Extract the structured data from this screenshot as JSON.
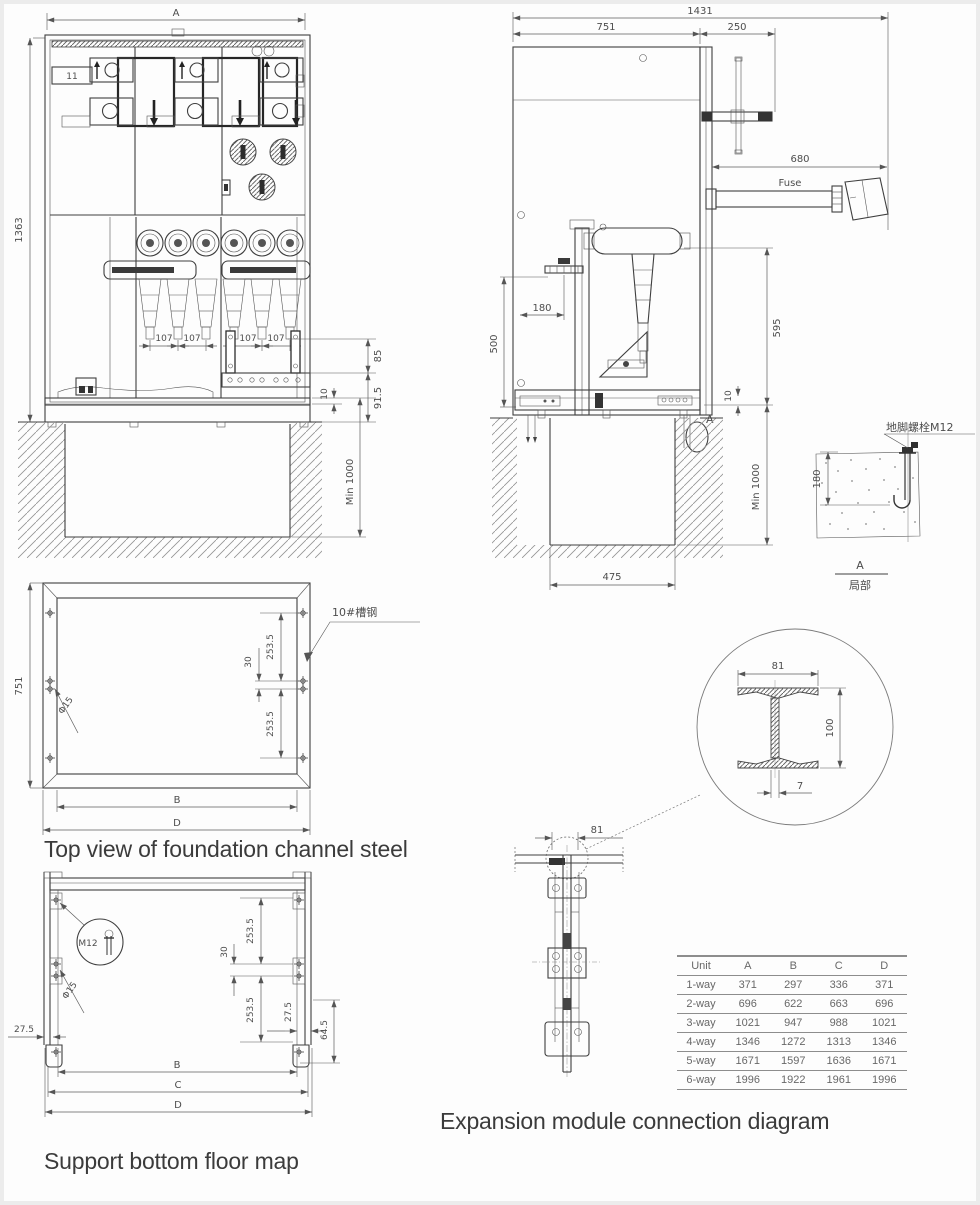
{
  "captions": {
    "foundation": "Top view of foundation channel steel",
    "support": "Support bottom floor map",
    "expansion": "Expansion module connection diagram"
  },
  "front_view": {
    "dim_width": "A",
    "dim_height": "1363",
    "dim_spacing": "107",
    "dim_85": "85",
    "dim_91_5": "91.5",
    "dim_10": "10",
    "dim_min_depth": "Min 1000",
    "panel_label": "11"
  },
  "side_view": {
    "dim_total_width": "1431",
    "dim_751": "751",
    "dim_250": "250",
    "dim_680": "680",
    "fuse_label": "Fuse",
    "dim_180": "180",
    "dim_500": "500",
    "dim_595": "595",
    "dim_10": "10",
    "dim_min_depth": "Min 1000",
    "dim_475": "475",
    "detail_marker": "A"
  },
  "anchor_detail": {
    "bolt_label": "地脚螺栓M12",
    "dim_180": "180",
    "marker": "A",
    "marker_caption": "局部"
  },
  "foundation_view": {
    "dim_751": "751",
    "hole_label": "Φ15",
    "channel_label": "10#槽钢",
    "dim_30": "30",
    "dim_253_5": "253.5",
    "dim_b": "B",
    "dim_d": "D"
  },
  "support_view": {
    "bolt_label": "M12",
    "hole_label": "Φ15",
    "dim_27_5": "27.5",
    "dim_30": "30",
    "dim_253_5": "253.5",
    "dim_64_5": "64.5",
    "dim_b": "B",
    "dim_c": "C",
    "dim_d": "D"
  },
  "expansion_view": {
    "dim_81": "81",
    "beam_dim_81": "81",
    "beam_dim_100": "100",
    "beam_dim_7": "7"
  },
  "table": {
    "headers": [
      "Unit",
      "A",
      "B",
      "C",
      "D"
    ],
    "rows": [
      [
        "1-way",
        "371",
        "297",
        "336",
        "371"
      ],
      [
        "2-way",
        "696",
        "622",
        "663",
        "696"
      ],
      [
        "3-way",
        "1021",
        "947",
        "988",
        "1021"
      ],
      [
        "4-way",
        "1346",
        "1272",
        "1313",
        "1346"
      ],
      [
        "5-way",
        "1671",
        "1597",
        "1636",
        "1671"
      ],
      [
        "6-way",
        "1996",
        "1922",
        "1961",
        "1996"
      ]
    ]
  }
}
